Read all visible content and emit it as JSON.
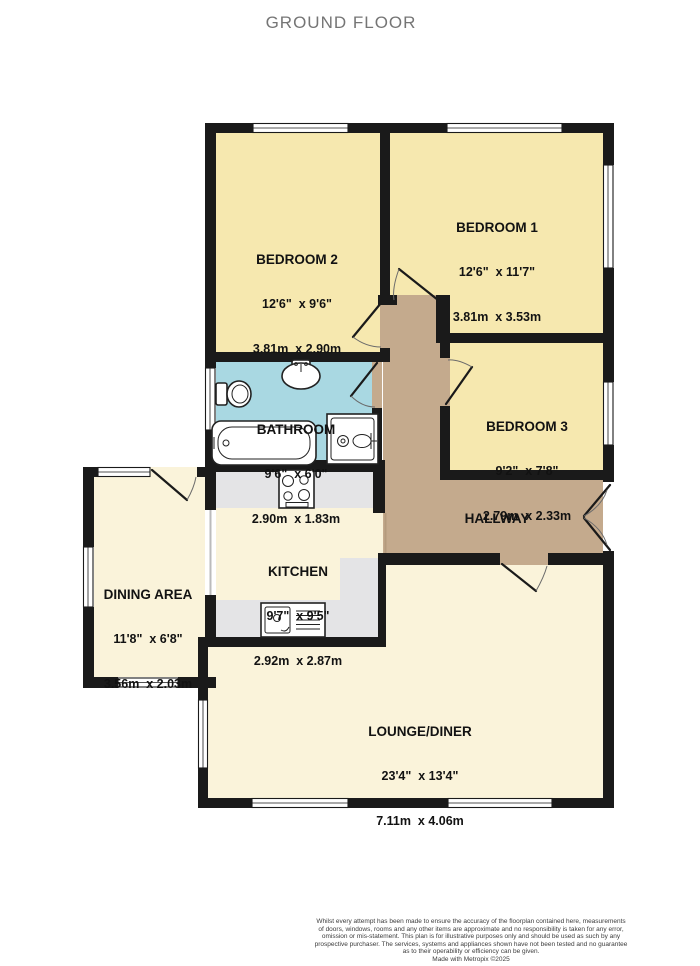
{
  "title": "GROUND FLOOR",
  "rooms": {
    "bedroom1": {
      "name": "BEDROOM 1",
      "imperial": "12'6\"  x 11'7\"",
      "metric": "3.81m  x 3.53m"
    },
    "bedroom2": {
      "name": "BEDROOM 2",
      "imperial": "12'6\"  x 9'6\"",
      "metric": "3.81m  x 2.90m"
    },
    "bedroom3": {
      "name": "BEDROOM 3",
      "imperial": "9'2\"  x 7'8\"",
      "metric": "2.79m  x 2.33m"
    },
    "bathroom": {
      "name": "BATHROOM",
      "imperial": "9'6\"  x 6'0\"",
      "metric": "2.90m  x 1.83m"
    },
    "kitchen": {
      "name": "KITCHEN",
      "imperial": "9'7\"  x 9'5\"",
      "metric": "2.92m  x 2.87m"
    },
    "dining": {
      "name": "DINING AREA",
      "imperial": "11'8\"  x 6'8\"",
      "metric": "3.56m  x 2.03m"
    },
    "lounge": {
      "name": "LOUNGE/DINER",
      "imperial": "23'4\"  x 13'4\"",
      "metric": "7.11m  x 4.06m"
    },
    "hallway": {
      "name": "HALLWAY"
    }
  },
  "footer": {
    "lines": [
      "Whilst every attempt has been made to ensure the accuracy of the floorplan contained here, measurements",
      "of doors, windows, rooms and any other items are approximate and no responsibility is taken for any error,",
      "omission or mis-statement. This plan is for illustrative purposes only and should be used as such by any",
      "prospective purchaser. The services, systems and appliances shown have not been tested and no guarantee",
      "as to their operability or efficiency can be given."
    ],
    "credit": "Made with Metropix ©2025"
  },
  "colors": {
    "wall": "#1a1a1a",
    "bedroom": "#f6e8af",
    "bathroom-blue": "#a9d8e2",
    "cream": "#faf3da",
    "hallway-brown": "#c4aa8d",
    "counter": "#e4e4e6",
    "title-gray": "#757575"
  }
}
